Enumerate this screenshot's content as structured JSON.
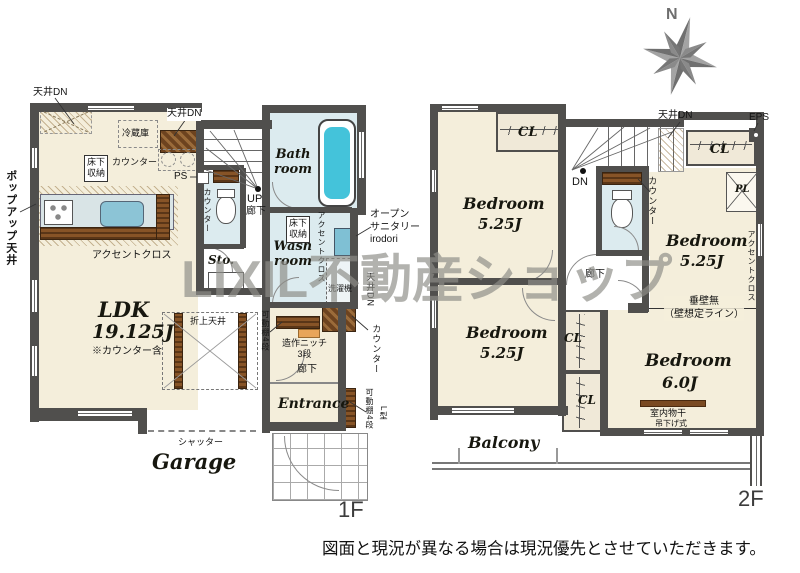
{
  "watermark": "LIXIL不動産ショップ",
  "compass_north": "N",
  "disclaimer": "図面と現況が異なる場合は現況優先とさせていただきます。",
  "f1": {
    "label": "1F",
    "ceiling_dn_a": "天井DN",
    "ceiling_dn_b": "天井DN",
    "fridge": "冷蔵庫",
    "counter_a": "カウンター",
    "underfloor_a": "床下\n収納",
    "ps": "PS",
    "popup_ceiling": "ポップアップ天井",
    "accent_cross_a": "アクセントクロス",
    "counter_b": "カウンター",
    "up": "UP",
    "hall_a": "廊下",
    "sto": "Sto.",
    "bath": "Bath\nroom",
    "wash": "Wash\nroom",
    "underfloor_b": "床下\n収納",
    "accent_cross_b": "アクセントクロス",
    "open_sanitary": "オープン\nサニタリー\nirodori",
    "washer": "洗濯機",
    "ceiling_dn_c": "天井DN",
    "counter_c": "カウンター",
    "ldk_name": "LDK",
    "ldk_size": "19.125J",
    "ldk_note": "※カウンター含",
    "coffered": "折上天井",
    "shelf_a": "可動棚4段",
    "niche": "造作ニッチ\n3段",
    "hall_b": "廊下",
    "entrance": "Entrance",
    "shelf_b": "可動棚4段",
    "shelf_b_type": "L型",
    "shutter": "シャッター",
    "garage": "Garage"
  },
  "f2": {
    "label": "2F",
    "bedroom_nw_name": "Bedroom",
    "bedroom_nw_size": "5.25J",
    "bedroom_ne_name": "Bedroom",
    "bedroom_ne_size": "5.25J",
    "bedroom_sw_name": "Bedroom",
    "bedroom_sw_size": "5.25J",
    "bedroom_se_name": "Bedroom",
    "bedroom_se_size": "6.0J",
    "cl_nw": "CL",
    "cl_ne": "CL",
    "cl_mid_a": "CL",
    "cl_mid_b": "CL",
    "dn": "DN",
    "ceiling_dn": "天井DN",
    "eps": "EPS",
    "pl": "PL",
    "counter": "カウンター",
    "accent_cross": "アクセントクロス",
    "hall": "廊下",
    "no_hanging_wall": "垂壁無\n（壁想定ライン）",
    "indoor_drying": "室内物干",
    "indoor_drying_type": "吊下げ式",
    "balcony": "Balcony"
  }
}
